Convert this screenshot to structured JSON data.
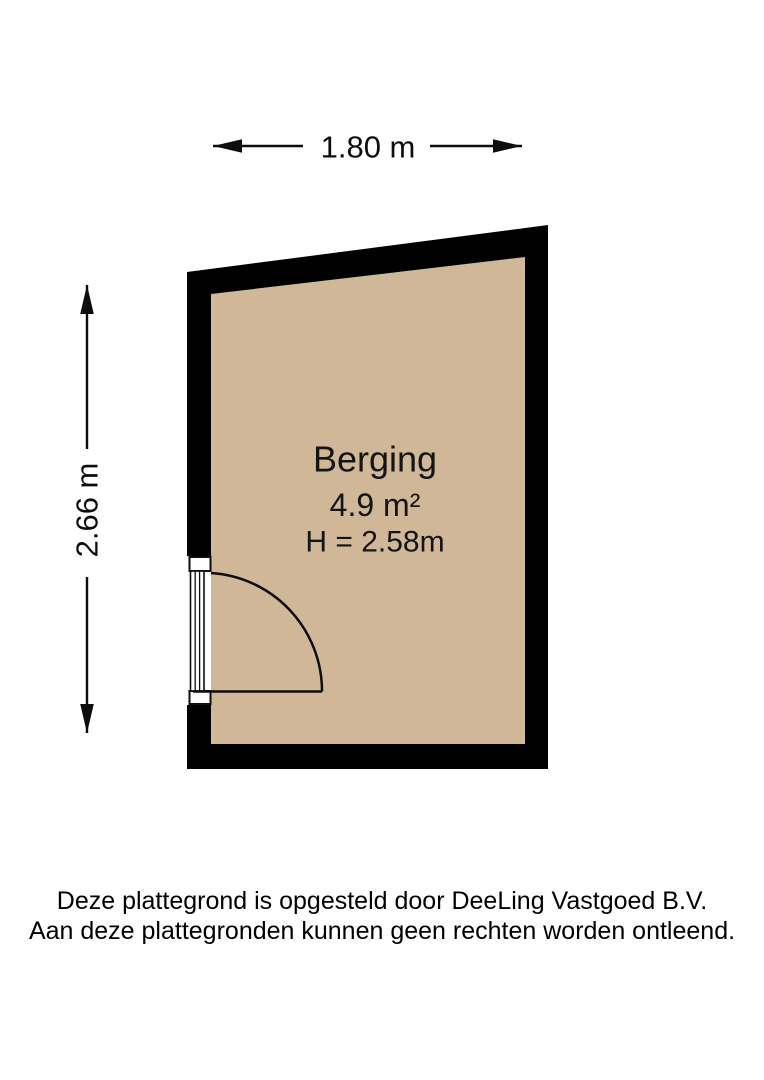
{
  "colors": {
    "background": "#ffffff",
    "wall": "#000000",
    "floor": "#cfb797",
    "line": "#0d0d0d"
  },
  "dimensions": {
    "width_label": "1.80 m",
    "height_label": "2.66 m"
  },
  "room": {
    "name": "Berging",
    "area": "4.9 m²",
    "ceiling_height": "H = 2.58m"
  },
  "footer": {
    "line1": "Deze plattegrond is opgesteld door DeeLing Vastgoed B.V.",
    "line2": "Aan deze plattegronden kunnen geen rechten worden ontleend."
  }
}
